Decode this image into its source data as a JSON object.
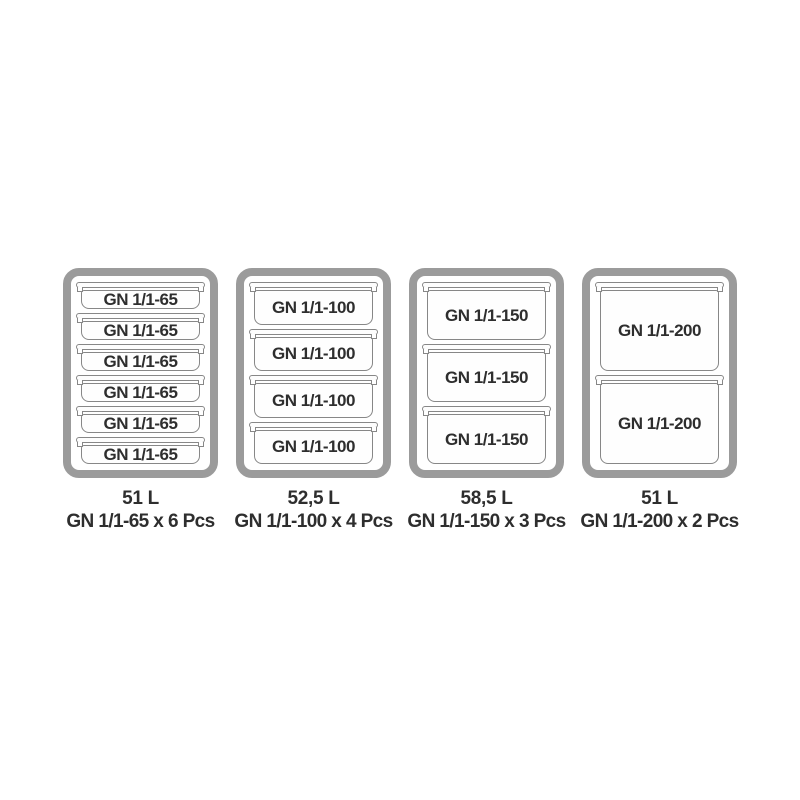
{
  "colors": {
    "background": "#ffffff",
    "frame_border": "#9b9b9b",
    "container_outline": "#878787",
    "text": "#2e2e2e"
  },
  "groups": [
    {
      "label": "GN 1/1-65",
      "count": 6,
      "volume": "51 L",
      "caption": "GN 1/1-65 x 6 Pcs"
    },
    {
      "label": "GN 1/1-100",
      "count": 4,
      "volume": "52,5 L",
      "caption": "GN 1/1-100 x 4 Pcs"
    },
    {
      "label": "GN 1/1-150",
      "count": 3,
      "volume": "58,5 L",
      "caption": "GN 1/1-150 x 3 Pcs"
    },
    {
      "label": "GN 1/1-200",
      "count": 2,
      "volume": "51 L",
      "caption": "GN 1/1-200 x 2 Pcs"
    }
  ]
}
